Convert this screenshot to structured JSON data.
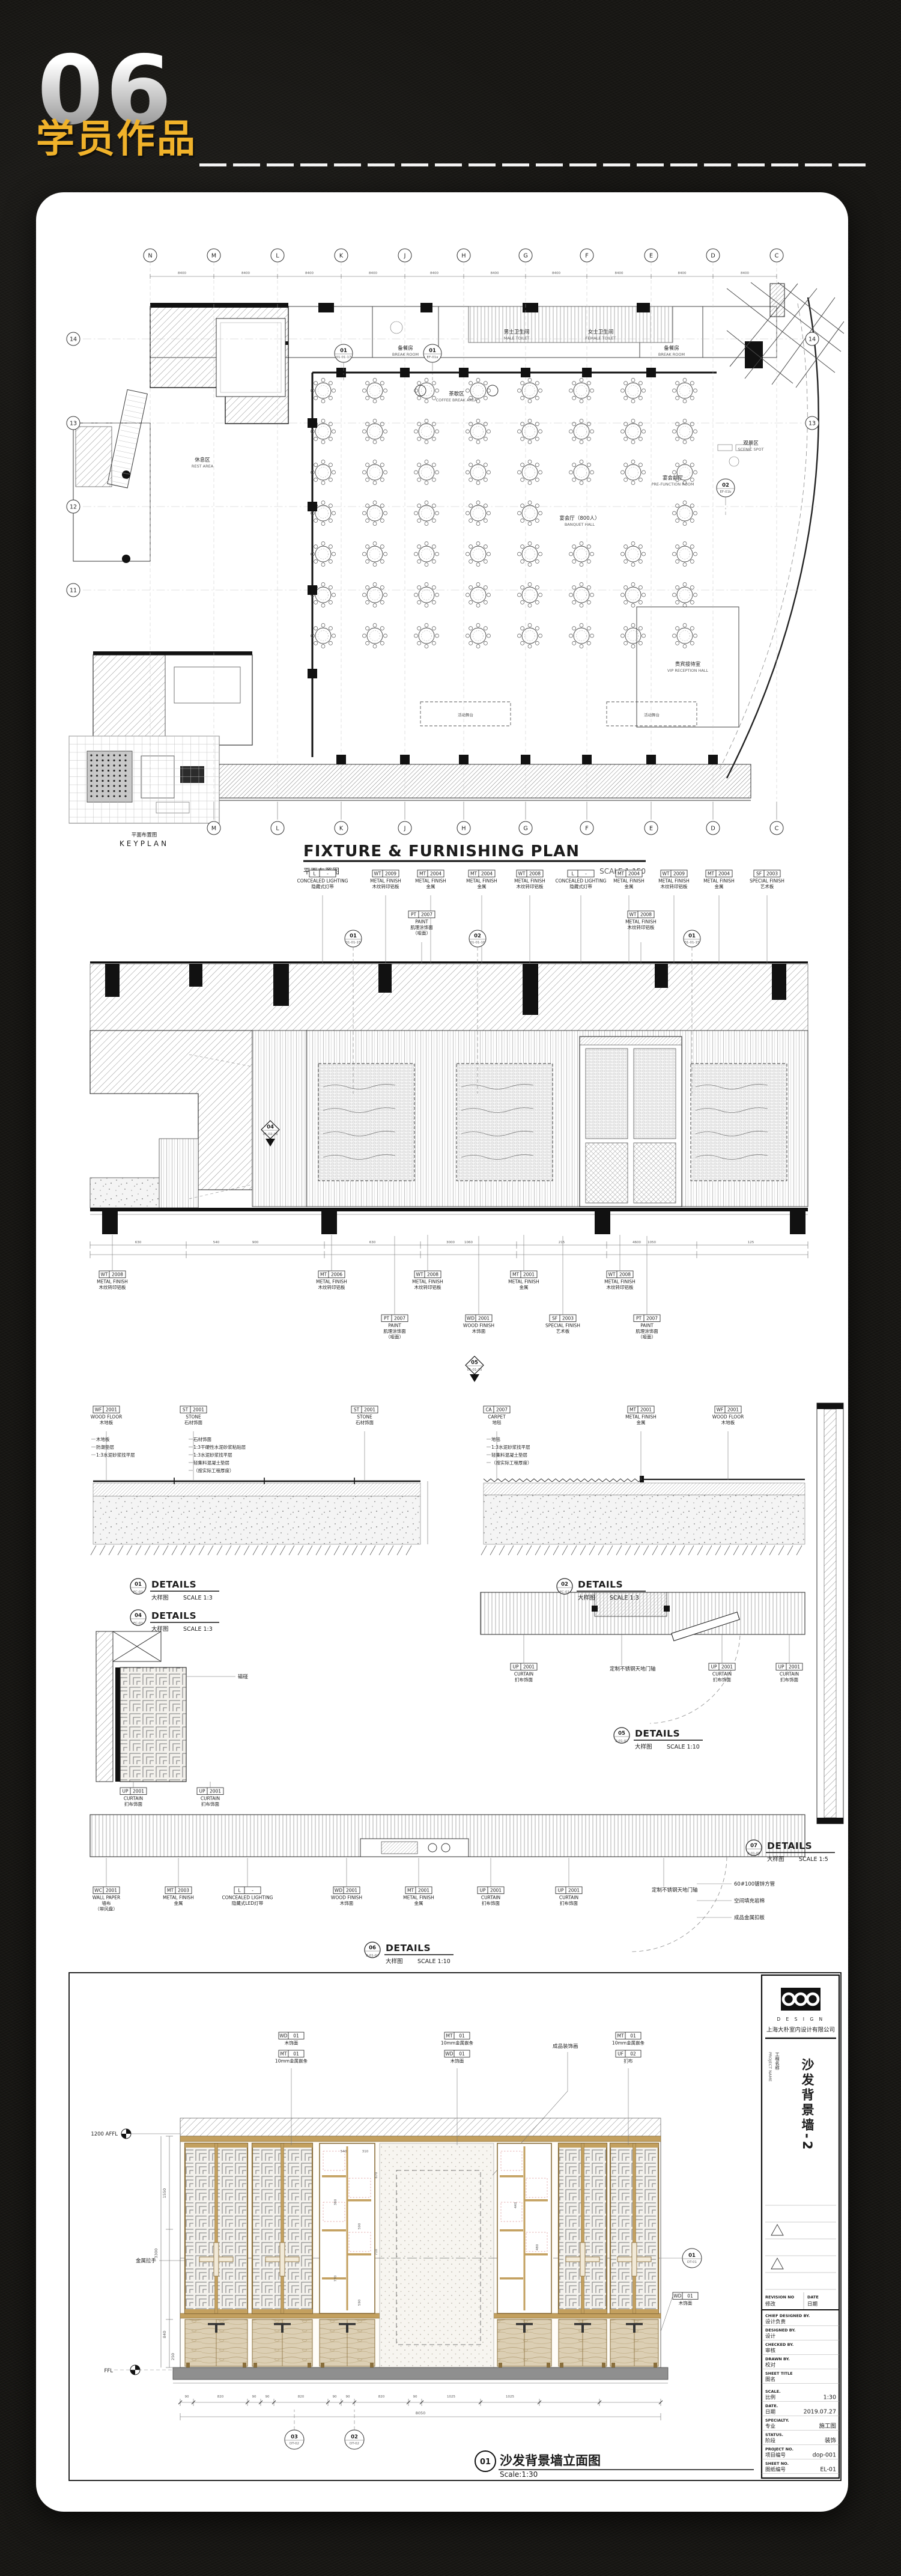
{
  "header": {
    "number": "06",
    "title": "学员作品"
  },
  "plan": {
    "title": "FIXTURE & FURNISHING PLAN",
    "subtitle": "平面布置图",
    "scale": "SCALE 1:150",
    "span": "8400",
    "grid_top": [
      "N",
      "M",
      "L",
      "K",
      "J",
      "H",
      "G",
      "F",
      "E",
      "D",
      "C"
    ],
    "grid_bottom": [
      "M",
      "L",
      "K",
      "J",
      "H",
      "G",
      "F",
      "E",
      "D",
      "C"
    ],
    "grid_left": [
      "14",
      "13",
      "12",
      "11"
    ],
    "grid_right": [
      "14",
      "13"
    ],
    "tags": [
      {
        "no": "01",
        "ref": "01-01-17"
      },
      {
        "no": "01",
        "ref": "EF-01a"
      },
      {
        "no": "02",
        "ref": "EF-01b"
      }
    ],
    "labels": {
      "rest": {
        "cn": "休息区",
        "en": "REST AREA"
      },
      "coffee": {
        "cn": "茶歇区",
        "en": "COFFEE BREAK AREA"
      },
      "break1": {
        "cn": "备餐房",
        "en": "BREAK ROOM"
      },
      "break2": {
        "cn": "备餐房",
        "en": "BREAK ROOM"
      },
      "male": {
        "cn": "男士卫生间",
        "en": "MALE TOILET"
      },
      "female": {
        "cn": "女士卫生间",
        "en": "FEMALE TOILET"
      },
      "prefunction": {
        "cn": "宴会前厅",
        "en": "PRE-FUNCTION ROOM"
      },
      "banquet": {
        "cn": "宴会厅（800人）",
        "en": "BANQUET HALL"
      },
      "scenic": {
        "cn": "观景区",
        "en": "SCENIC SPOT"
      },
      "vip": {
        "cn": "贵宾接待室",
        "en": "VIP RECEPTION HALL"
      },
      "stage": {
        "cn": "活动舞台"
      },
      "keyplan_cn": "平面布置图",
      "keyplan_en": "KEYPLAN"
    }
  },
  "elevation": {
    "top": [
      {
        "c": "L",
        "n": "-",
        "l1": "CONCEALED LIGHTING",
        "l2": "隐藏式灯带"
      },
      {
        "c": "WT",
        "n": "2009",
        "l1": "METAL FINISH",
        "l2": "木纹转印铝板"
      },
      {
        "c": "MT",
        "n": "2004",
        "l1": "METAL FINISH",
        "l2": "金属"
      },
      {
        "c": "MT",
        "n": "2004",
        "l1": "METAL FINISH",
        "l2": "金属"
      },
      {
        "c": "WT",
        "n": "2008",
        "l1": "METAL FINISH",
        "l2": "木纹转印铝板"
      },
      {
        "c": "L",
        "n": "-",
        "l1": "CONCEALED LIGHTING",
        "l2": "隐藏式灯带"
      },
      {
        "c": "MT",
        "n": "2004",
        "l1": "METAL FINISH",
        "l2": "金属"
      },
      {
        "c": "WT",
        "n": "2009",
        "l1": "METAL FINISH",
        "l2": "木纹转印铝板"
      },
      {
        "c": "MT",
        "n": "2004",
        "l1": "METAL FINISH",
        "l2": "金属"
      },
      {
        "c": "SF",
        "n": "2003",
        "l1": "SPECIAL FINISH",
        "l2": "艺术板"
      }
    ],
    "top2": [
      {
        "c": "PT",
        "n": "2007",
        "l1": "PAINT",
        "l2": "肌理涂饰面",
        "l3": "（哑面）"
      },
      {
        "c": "WT",
        "n": "2008",
        "l1": "METAL FINISH",
        "l2": "木纹转印铝板"
      }
    ],
    "tags": [
      {
        "no": "01",
        "ref": "01-01-15"
      },
      {
        "no": "02",
        "ref": "01-01-16"
      },
      {
        "no": "01",
        "ref": "01-01-15"
      }
    ],
    "b1": [
      {
        "c": "WT",
        "n": "2008",
        "l1": "METAL FINISH",
        "l2": "木纹转印铝板"
      },
      {
        "c": "MT",
        "n": "2006",
        "l1": "METAL FINISH",
        "l2": "木纹转印铝板"
      },
      {
        "c": "WT",
        "n": "2008",
        "l1": "METAL FINISH",
        "l2": "木纹转印铝板"
      },
      {
        "c": "MT",
        "n": "2001",
        "l1": "METAL FINISH",
        "l2": "金属"
      },
      {
        "c": "WT",
        "n": "2008",
        "l1": "METAL FINISH",
        "l2": "木纹转印铝板"
      }
    ],
    "b2": [
      {
        "c": "PT",
        "n": "2007",
        "l1": "PAINT",
        "l2": "肌理涂饰面",
        "l3": "（哑面）"
      },
      {
        "c": "WD",
        "n": "2001",
        "l1": "WOOD FINISH",
        "l2": "木饰面"
      },
      {
        "c": "SF",
        "n": "2003",
        "l1": "SPECIAL FINISH",
        "l2": "艺术板"
      },
      {
        "c": "PT",
        "n": "2007",
        "l1": "PAINT",
        "l2": "肌理涂饰面",
        "l3": "（哑面）"
      }
    ],
    "d04": {
      "no": "04",
      "ref": "01-02-16"
    },
    "d05": {
      "no": "05",
      "ref": "01-01-15"
    },
    "dims": [
      "630",
      "900",
      "630",
      "1060",
      "215",
      "1050",
      "125",
      "540",
      "3000",
      "4600"
    ]
  },
  "details": {
    "t01": {
      "no": "01",
      "ref": "FC-01",
      "t": "DETAILS",
      "sub": "大样图",
      "scale": "SCALE 1:3"
    },
    "t02": {
      "no": "02",
      "ref": "FC-01",
      "t": "DETAILS",
      "sub": "大样图",
      "scale": "SCALE 1:3"
    },
    "t04": {
      "no": "04",
      "ref": "FC-01",
      "t": "DETAILS",
      "sub": "大样图",
      "scale": "SCALE 1:3"
    },
    "t05": {
      "no": "05",
      "ref": "E-01-02",
      "t": "DETAILS",
      "sub": "大样图",
      "scale": "SCALE 1:10"
    },
    "t06": {
      "no": "06",
      "ref": "E-01-04",
      "t": "DETAILS",
      "sub": "大样图",
      "scale": "SCALE 1:10"
    },
    "t07": {
      "no": "07",
      "ref": "E-01-05",
      "t": "DETAILS",
      "sub": "大样图",
      "scale": "SCALE 1:5"
    },
    "wf": {
      "c": "WF",
      "n": "2001",
      "l1": "WOOD FLOOR",
      "l2": "木地板"
    },
    "st": {
      "c": "ST",
      "n": "2001",
      "l1": "STONE",
      "l2": "石材饰面"
    },
    "ca": {
      "c": "CA",
      "n": "2007",
      "l1": "CARPET",
      "l2": "地毯"
    },
    "mt1": {
      "c": "MT",
      "n": "2001",
      "l1": "METAL FINISH",
      "l2": "金属"
    },
    "mt3": {
      "c": "MT",
      "n": "2003",
      "l1": "METAL FINISH",
      "l2": "金属"
    },
    "up": {
      "c": "UP",
      "n": "2001",
      "l1": "CURTAIN",
      "l2": "扪布饰面"
    },
    "wc": {
      "c": "WC",
      "n": "2001",
      "l1": "WALL PAPER",
      "l2": "墙布",
      "l3": "（带风盘）"
    },
    "led": {
      "c": "L",
      "n": "-",
      "l1": "CONCEALED LIGHTING",
      "l2": "隐藏式LED灯带"
    },
    "wd": {
      "c": "WD",
      "n": "2001",
      "l1": "WOOD FINISH",
      "l2": "木饰面"
    },
    "layers1": [
      "石材饰面",
      "1:3干硬性水泥砂浆粘贴层",
      "1:3水泥砂浆找平层",
      "轻集料混凝土垫层",
      "（按实际工程厚度）"
    ],
    "layers2": [
      "木地板",
      "防潮垫层",
      "1:3水泥砂浆找平层"
    ],
    "layers3": [
      "地毯",
      "1:3水泥砂浆找平层",
      "轻集料混凝土垫层",
      "（按实际工程厚度）"
    ],
    "pivot": "定制不锈钢天地门轴",
    "magnet": "磁碰",
    "stack": [
      "60#100镀锌方管",
      "空间填充岩棉",
      "成品金属扣板"
    ]
  },
  "final": {
    "wd": {
      "c": "WD",
      "n": "01",
      "l1": "木饰面"
    },
    "mt": {
      "c": "MT",
      "n": "01",
      "l1": "10mm金属嵌条"
    },
    "uf": {
      "c": "UF",
      "n": "02",
      "l1": "扪布"
    },
    "art": "成品装饰画",
    "handle": "金属拉手",
    "affl": "1200 AFFL",
    "ffl": "FFL",
    "tag_right": {
      "no": "01",
      "ref": "DT-01"
    },
    "tag03": {
      "no": "03",
      "ref": "DT-02"
    },
    "tag02": {
      "no": "02",
      "ref": "DT-02"
    },
    "dims_left": [
      "1550",
      "3300",
      "840",
      "250"
    ],
    "dims_bottom": [
      "90",
      "820",
      "90",
      "90",
      "820",
      "90",
      "90",
      "820",
      "90",
      "1025",
      "1025"
    ],
    "total": "8050",
    "inner": [
      "540",
      "310",
      "670",
      "380",
      "590",
      "710",
      "770",
      "590",
      "440",
      "480"
    ],
    "title_no": "01",
    "title": "沙发背景墙立面图",
    "title_scale": "Scale:1:30"
  },
  "sheet": {
    "logo_sub": "D E S I G N",
    "company": "上海大朴室内设计有限公司",
    "project_label": "PROJECT NAME",
    "project_label_cn": "工程名称",
    "project_name": "沙发背景墙-2",
    "rev_en": "REVISION NO",
    "rev_cn": "修改",
    "date_en": "DATE",
    "date_cn": "日期",
    "rows": [
      {
        "en": "CHIEF DESIGNED BY.",
        "cn": "设计负责"
      },
      {
        "en": "DESIGNED BY.",
        "cn": "设计"
      },
      {
        "en": "CHECKED BY.",
        "cn": "审核"
      },
      {
        "en": "DRAWN BY.",
        "cn": "校对"
      },
      {
        "en": "SHEET TITLE",
        "cn": "图名"
      }
    ],
    "info": [
      {
        "en": "SCALE.",
        "cn": "比例",
        "val": "1:30"
      },
      {
        "en": "DATE.",
        "cn": "日期",
        "val": "2019.07.27"
      },
      {
        "en": "SPECIALTY.",
        "cn": "专业",
        "val": "施工图"
      },
      {
        "en": "STATUS.",
        "cn": "阶段",
        "val": "装饰"
      },
      {
        "en": "PROJECT NO.",
        "cn": "项目编号",
        "val": "dop-001"
      },
      {
        "en": "SHEET NO.",
        "cn": "图纸编号",
        "val": "EL-01"
      }
    ]
  }
}
